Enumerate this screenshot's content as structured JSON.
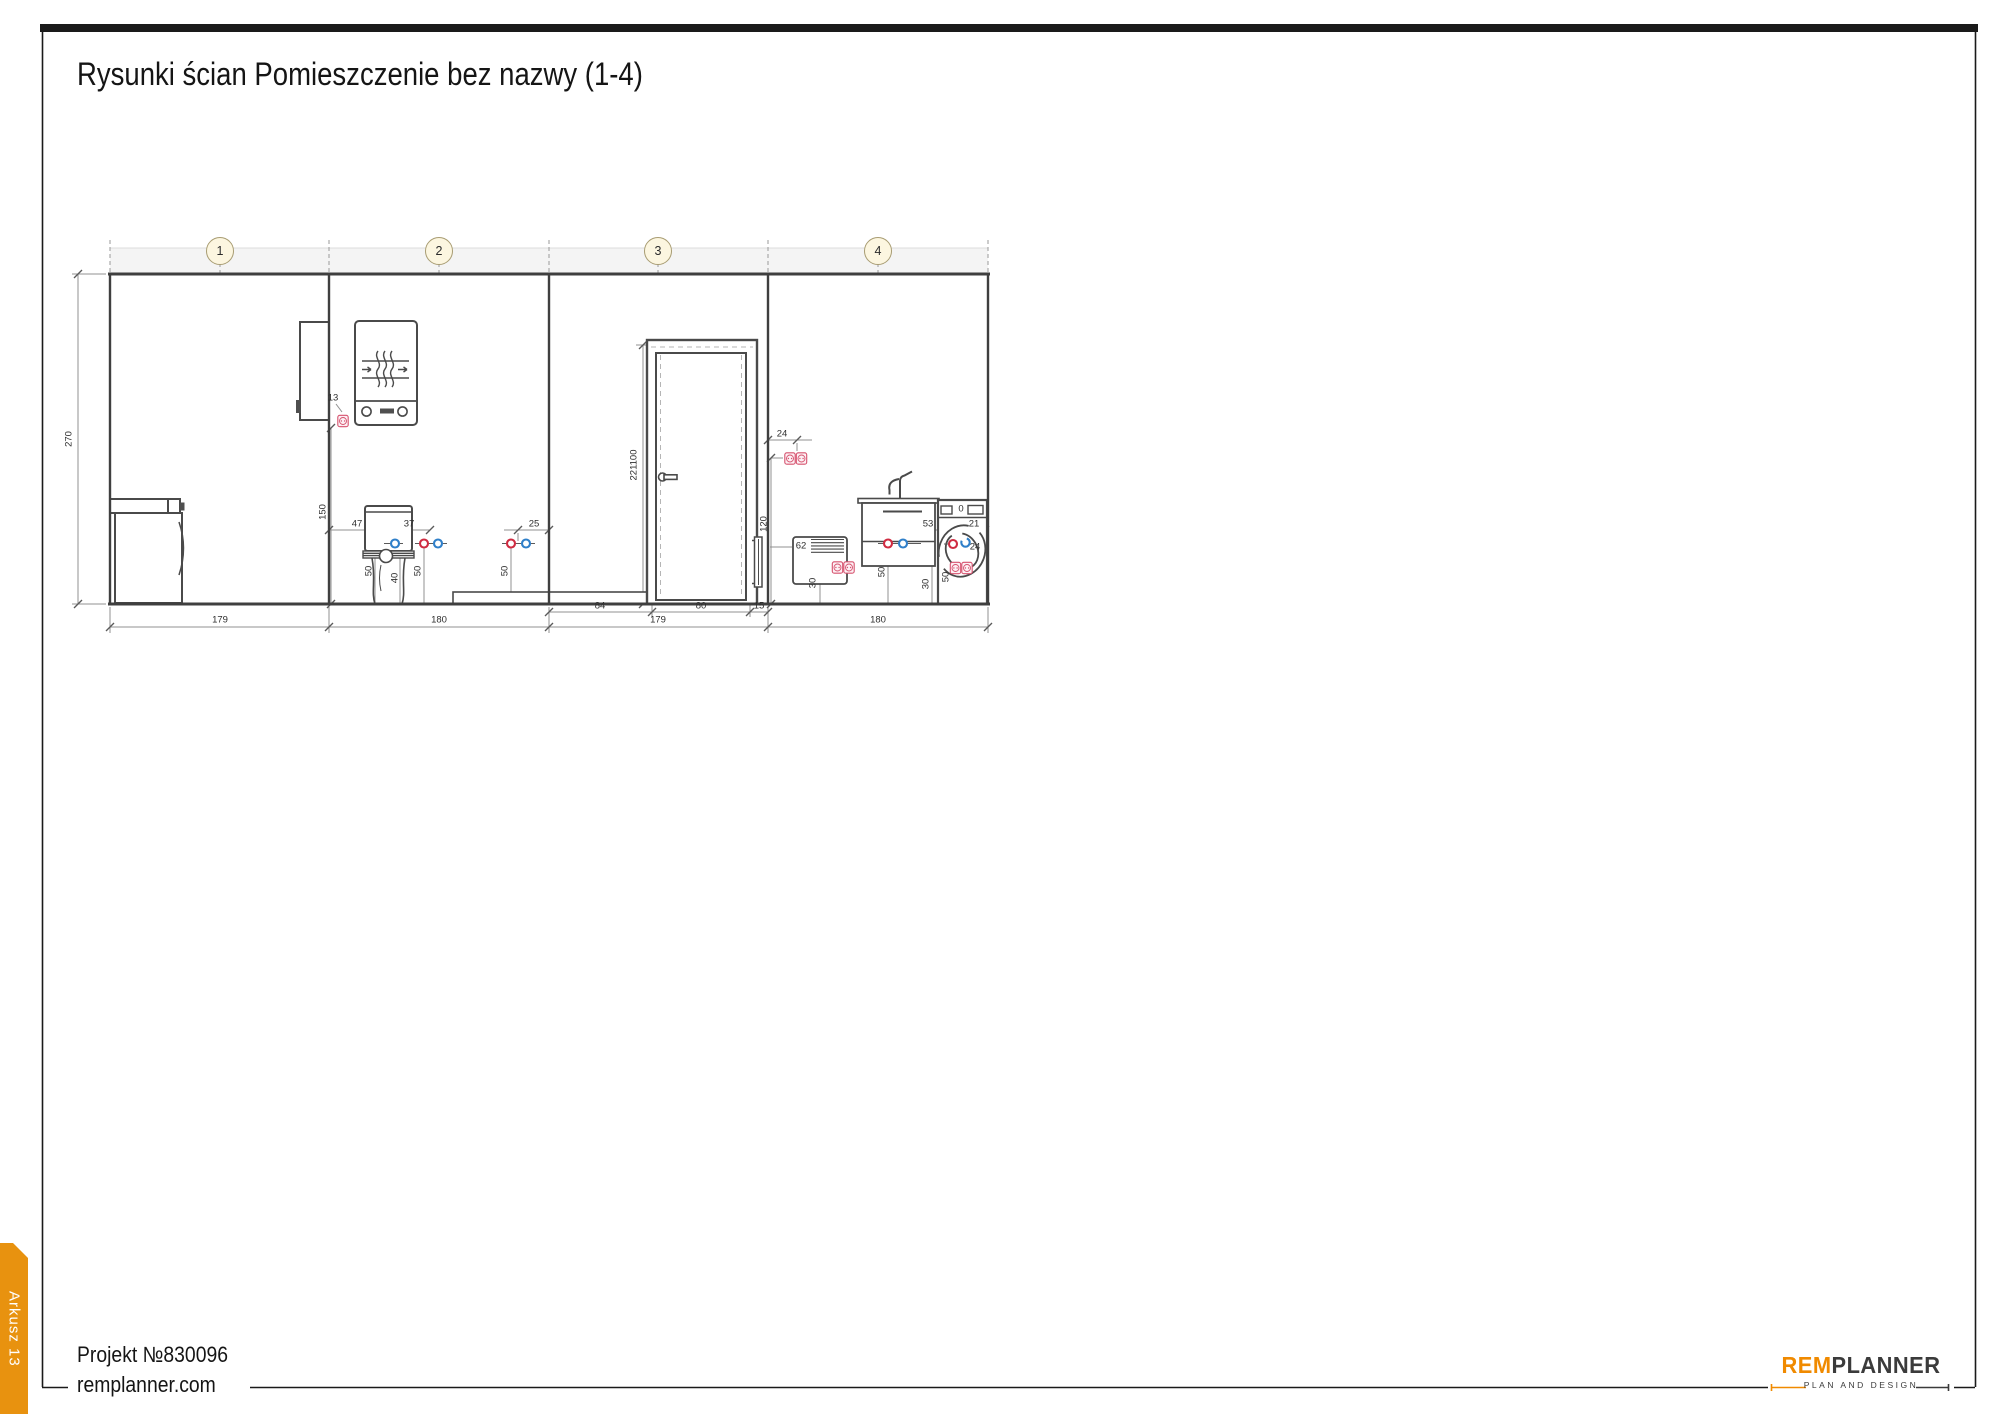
{
  "page": {
    "title": "Rysunki ścian Pomieszczenie bez nazwy (1-4)",
    "sheet_tab": "Arkusz 13",
    "project_no": "Projekt №830096",
    "website": "remplanner.com"
  },
  "logo": {
    "brand_left": "REM",
    "brand_right": "PLANNER",
    "tagline": "PLAN AND DESIGN",
    "orange": "#F08A00",
    "dark": "#3b3b3b"
  },
  "markers": [
    "1",
    "2",
    "3",
    "4"
  ],
  "dimensions": {
    "ceiling_height": "270",
    "wall1_width": "179",
    "wall2_width": "180",
    "wall3_width": "179",
    "wall4_width": "180",
    "door_offset_left": "84",
    "door_width": "80",
    "door_offset_right": "15",
    "door_height_and_handle": "221100",
    "boiler_socket_offset": "13",
    "boiler_socket_height": "150",
    "toilet_offset_left": "47",
    "toilet_offset_right": "37",
    "toilet_point_height_left": "50",
    "toilet_drain_height": "40",
    "toilet_point_height_right": "50",
    "shower_points_offset": "25",
    "shower_point_height": "50",
    "w4_socket_offset": "24",
    "w4_socket_height": "120",
    "convector_ref": "62",
    "convector_socket_height": "30",
    "sink_points_dim": "53",
    "wm_door_dim": "21",
    "sink_point_height": "50",
    "wm_gap_height": "30",
    "wm_point_height": "50",
    "wm_point_offset": "24",
    "wm_knob": "0"
  },
  "colors": {
    "accent_orange": "#E8920F",
    "socket_pink": "#d6536f",
    "hot_water_red": "#cf2b41",
    "cold_water_blue": "#2f7fc9",
    "marker_fill": "#fcf6e0",
    "ceiling_band": "#f4f4f4"
  }
}
